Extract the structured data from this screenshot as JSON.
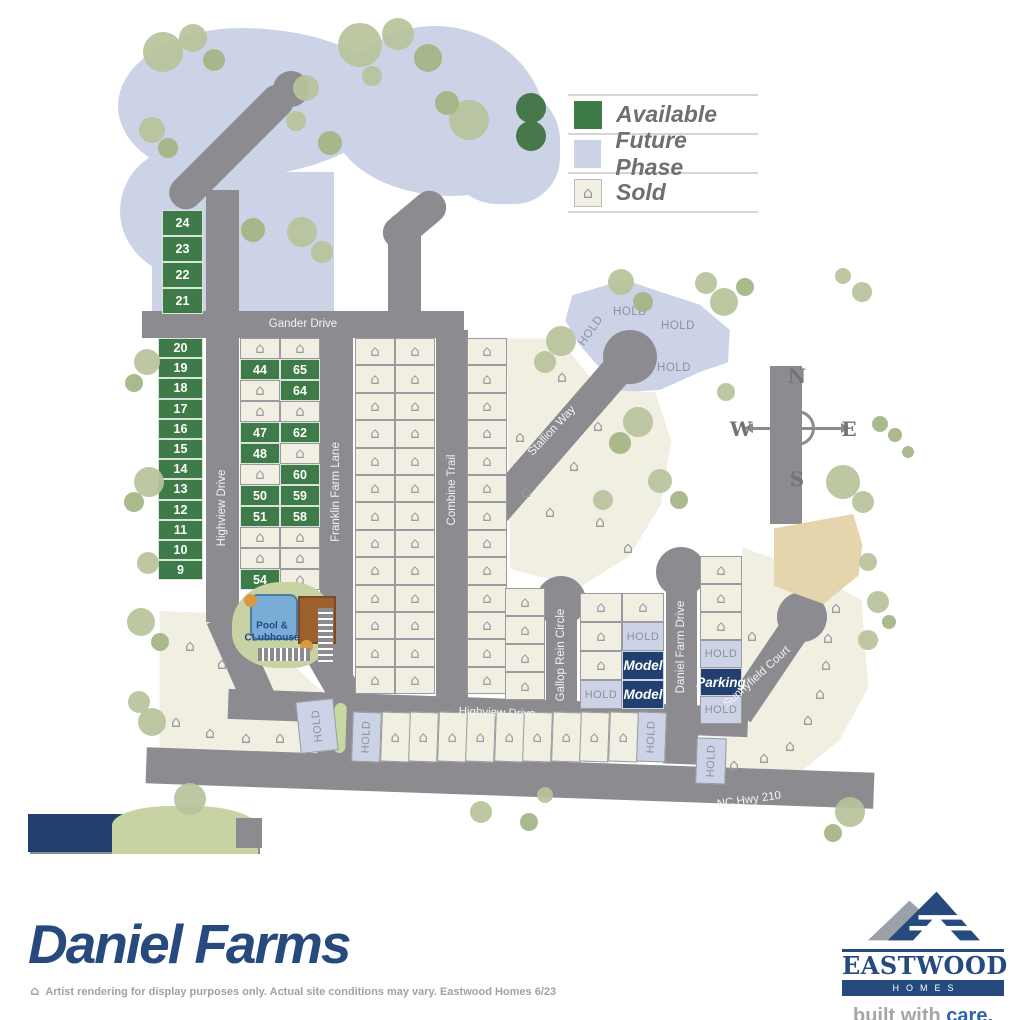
{
  "colors": {
    "road": "#8b8b90",
    "available": "#3e7b48",
    "sold_fill": "#f1eee2",
    "sold_border": "#9a9aa0",
    "future": "#ccd3e7",
    "hold_text": "#8f909a",
    "navy": "#21406f",
    "brand": "#26497e",
    "tan": "#e5d5ad",
    "tree_light": "#b7c29a",
    "tree_mid": "#a3b483",
    "tree_dark": "#47784b",
    "pool_green": "#c8d3a3",
    "pool_blue": "#79add8",
    "clubhouse": "#9c5f2e",
    "median": "#c9d8a0",
    "care_blue": "#2f63ae",
    "legend_text": "#6f6f6f"
  },
  "icons": {
    "house": "⌂"
  },
  "labels": {
    "hold": "HOLD",
    "model": "Model",
    "parking": "Parking"
  },
  "legend": {
    "items": [
      {
        "label": "Available",
        "type": "available"
      },
      {
        "label": "Future Phase",
        "type": "future"
      },
      {
        "label": "Sold",
        "type": "sold"
      }
    ]
  },
  "compass": {
    "n": "N",
    "w": "W",
    "e": "E",
    "s": "S"
  },
  "pool": {
    "line1": "Pool &",
    "line2": "CLubhouse"
  },
  "brand": {
    "title": "Daniel Farms"
  },
  "footer": {
    "disclaimer": "Artist rendering for display purposes only. Actual site conditions may vary. Eastwood Homes 6/23"
  },
  "logo": {
    "name": "EASTWOOD",
    "sub": "HOMES",
    "tag1": "built with ",
    "tag2": "care."
  },
  "map": {
    "future": [
      {
        "x": 118,
        "y": 28,
        "w": 272,
        "h": 150,
        "br": "45% 55% 62% 38% / 52% 46% 54% 48%"
      },
      {
        "x": 120,
        "y": 148,
        "w": 148,
        "h": 132,
        "br": "42% 58% 46% 54% / 48% 42% 58% 52%"
      },
      {
        "x": 152,
        "y": 172,
        "w": 182,
        "h": 142,
        "br": "0"
      },
      {
        "x": 332,
        "y": 26,
        "w": 214,
        "h": 170,
        "br": "48% 52% 44% 56% / 55% 60% 40% 45%"
      },
      {
        "x": 446,
        "y": 88,
        "w": 114,
        "h": 116,
        "br": "40% 45% 40% 45%"
      }
    ],
    "polys": [
      {
        "x": 560,
        "y": 276,
        "w": 175,
        "h": 120,
        "bg": "future",
        "clip": "polygon(7% 16%,37% 3%,57% 13%,80% 24%,97% 45%,96% 72%,80% 80%,57% 95%,35% 97%,11% 57%,3% 37%)"
      },
      {
        "x": 505,
        "y": 336,
        "w": 175,
        "h": 256,
        "bg": "sold_fill",
        "clip": "polygon(1% 1%,31% 1%,54% 21%,86% 22%,95% 41%,89% 66%,71% 86%,43% 98%,3% 91%)"
      },
      {
        "x": 700,
        "y": 545,
        "w": 170,
        "h": 238,
        "bg": "sold_fill",
        "clip": "polygon(25% 1%,60% 10%,95% 23%,99% 60%,82% 82%,53% 99%,6% 93%,1% 72%,24% 64%)"
      },
      {
        "x": 156,
        "y": 608,
        "w": 180,
        "h": 150,
        "bg": "sold_fill",
        "clip": "polygon(2% 2%,45% 4%,98% 62%,99% 98%,2% 98%)"
      }
    ],
    "roads": [
      {
        "x": 206,
        "y": 190,
        "w": 33,
        "h": 432
      },
      {
        "x": 215,
        "y": 66,
        "w": 33,
        "h": 162,
        "rot": 45,
        "rx": 16
      },
      {
        "x": 142,
        "y": 311,
        "w": 322,
        "h": 27
      },
      {
        "x": 320,
        "y": 330,
        "w": 33,
        "h": 345
      },
      {
        "x": 324,
        "y": 645,
        "w": 33,
        "h": 82,
        "rot": -30
      },
      {
        "x": 388,
        "y": 212,
        "w": 33,
        "h": 122,
        "rx": 16
      },
      {
        "x": 398,
        "y": 184,
        "w": 33,
        "h": 72,
        "rot": 50,
        "rx": 16
      },
      {
        "x": 436,
        "y": 330,
        "w": 32,
        "h": 378
      },
      {
        "x": 524,
        "y": 335,
        "w": 32,
        "h": 248,
        "rot": 41
      },
      {
        "x": 770,
        "y": 366,
        "w": 32,
        "h": 158
      },
      {
        "x": 546,
        "y": 598,
        "w": 31,
        "h": 112
      },
      {
        "x": 666,
        "y": 566,
        "w": 31,
        "h": 148
      },
      {
        "x": 753,
        "y": 613,
        "w": 31,
        "h": 110,
        "rot": 34
      },
      {
        "x": 228,
        "y": 698,
        "w": 520,
        "h": 30,
        "rot": 2
      },
      {
        "x": 146,
        "y": 760,
        "w": 728,
        "h": 36,
        "rot": 2
      },
      {
        "x": 318,
        "y": 696,
        "w": 46,
        "h": 64,
        "rot": 2
      },
      {
        "x": 664,
        "y": 712,
        "w": 34,
        "h": 52,
        "rot": 2
      },
      {
        "x": 224,
        "y": 613,
        "w": 34,
        "h": 92,
        "rot": -24
      },
      {
        "x": 30,
        "y": 820,
        "w": 230,
        "h": 34
      }
    ],
    "culdesacs": [
      [
        630,
        357,
        27
      ],
      [
        561,
        601,
        25
      ],
      [
        681,
        572,
        25
      ],
      [
        802,
        617,
        25
      ],
      [
        291,
        89,
        18
      ]
    ],
    "shapes": [
      {
        "nm": "open-space",
        "x": 774,
        "y": 514,
        "w": 92,
        "h": 90,
        "bg": "tan",
        "clip": "polygon(0% 16%,86% 0%,96% 34%,92% 68%,54% 100%,0% 80%)"
      },
      {
        "nm": "pond",
        "x": 28,
        "y": 814,
        "w": 130,
        "h": 38,
        "bg": "navy",
        "clip": "polygon(0 0,100% 0,70% 100%,0 100%)"
      },
      {
        "nm": "green-patch",
        "x": 112,
        "y": 806,
        "w": 146,
        "h": 48,
        "bg": "pool_green",
        "br": "40% 45% 0 0"
      },
      {
        "nm": "road-stub",
        "x": 236,
        "y": 818,
        "w": 26,
        "h": 30,
        "bg": "road"
      },
      {
        "nm": "median",
        "x": 334,
        "y": 703,
        "w": 12,
        "h": 50,
        "bg": "median",
        "br": "6px",
        "rot": 2
      }
    ],
    "grids": [
      {
        "x": 162,
        "y": 210,
        "cw": 41,
        "ch": 26,
        "cols": 1,
        "cells": [
          "a:24",
          "a:23",
          "a:22",
          "a:21"
        ]
      },
      {
        "x": 158,
        "y": 338,
        "cw": 45,
        "ch": 20.2,
        "cols": 1,
        "cells": [
          "a:20",
          "a:19",
          "a:18",
          "a:17",
          "a:16",
          "a:15",
          "a:14",
          "a:13",
          "a:12",
          "a:11",
          "a:10",
          "a:9"
        ]
      },
      {
        "x": 240,
        "y": 338,
        "cw": 40,
        "ch": 21,
        "cols": 2,
        "cells": [
          "s",
          "s",
          "a:44",
          "a:65",
          "s",
          "a:64",
          "s",
          "s",
          "a:47",
          "a:62",
          "a:48",
          "s",
          "s",
          "a:60",
          "a:50",
          "a:59",
          "a:51",
          "a:58",
          "s",
          "s",
          "s",
          "s",
          "a:54",
          "s"
        ]
      },
      {
        "x": 355,
        "y": 338,
        "cw": 40,
        "ch": 27.4,
        "cols": 2,
        "cells": [
          "s",
          "s",
          "s",
          "s",
          "s",
          "s",
          "s",
          "s",
          "s",
          "s",
          "s",
          "s",
          "s",
          "s",
          "s",
          "s",
          "s",
          "s",
          "s",
          "s",
          "s",
          "s",
          "s",
          "s",
          "s",
          "s"
        ]
      },
      {
        "x": 467,
        "y": 338,
        "cw": 40,
        "ch": 27.4,
        "cols": 1,
        "cells": [
          "s",
          "s",
          "s",
          "s",
          "s",
          "s",
          "s",
          "s",
          "s",
          "s",
          "s",
          "s",
          "s"
        ]
      },
      {
        "x": 505,
        "y": 588,
        "cw": 40,
        "ch": 28,
        "cols": 1,
        "cells": [
          "s",
          "s",
          "s",
          "s"
        ]
      },
      {
        "x": 580,
        "y": 593,
        "cw": 42,
        "ch": 29,
        "cols": 1,
        "cells": [
          "s",
          "s",
          "s",
          "h"
        ]
      },
      {
        "x": 622,
        "y": 593,
        "cw": 42,
        "ch": 29,
        "cols": 1,
        "cells": [
          "s",
          "h",
          "m",
          "m"
        ]
      },
      {
        "x": 700,
        "y": 556,
        "cw": 42,
        "ch": 28,
        "cols": 1,
        "cells": [
          "s",
          "s",
          "s",
          "h",
          "p",
          "h"
        ]
      },
      {
        "x": 352,
        "y": 712,
        "cw": 28.5,
        "ch": 50,
        "cols": 11,
        "rot": 2,
        "cells": [
          "hv",
          "s",
          "s",
          "s",
          "s",
          "s",
          "s",
          "s",
          "s",
          "s",
          "hv"
        ]
      }
    ],
    "lots": [
      {
        "x": 298,
        "y": 700,
        "w": 38,
        "h": 52,
        "rot": -6,
        "t": "hv"
      },
      {
        "x": 696,
        "y": 738,
        "w": 30,
        "h": 46,
        "rot": 2,
        "t": "hv"
      }
    ],
    "houses": [
      [
        520,
        437
      ],
      [
        526,
        492
      ],
      [
        550,
        512
      ],
      [
        574,
        466
      ],
      [
        598,
        426
      ],
      [
        562,
        377
      ],
      [
        600,
        522
      ],
      [
        628,
        548
      ],
      [
        752,
        636
      ],
      [
        828,
        638
      ],
      [
        826,
        665
      ],
      [
        820,
        694
      ],
      [
        808,
        720
      ],
      [
        790,
        746
      ],
      [
        764,
        758
      ],
      [
        734,
        765
      ],
      [
        836,
        608
      ],
      [
        190,
        646
      ],
      [
        222,
        664
      ],
      [
        176,
        722
      ],
      [
        210,
        733
      ],
      [
        246,
        738
      ],
      [
        280,
        738
      ]
    ],
    "hold_texts": [
      [
        630,
        312,
        0
      ],
      [
        678,
        326,
        0
      ],
      [
        674,
        368,
        0
      ],
      [
        591,
        331,
        -55
      ]
    ],
    "streets": [
      {
        "t": "Gander Drive",
        "x": 303,
        "y": 324,
        "r": 0
      },
      {
        "t": "Highview Drive",
        "x": 222,
        "y": 508,
        "r": -90
      },
      {
        "t": "Franklin Farm Lane",
        "x": 336,
        "y": 492,
        "r": -90
      },
      {
        "t": "Combine Trail",
        "x": 452,
        "y": 490,
        "r": -90
      },
      {
        "t": "Stallion Way",
        "x": 552,
        "y": 431,
        "r": -47
      },
      {
        "t": "Gallop Rein Circle",
        "x": 561,
        "y": 655,
        "r": -90
      },
      {
        "t": "Daniel Farm Drive",
        "x": 681,
        "y": 647,
        "r": -90
      },
      {
        "t": "Sunnyfield Court",
        "x": 757,
        "y": 677,
        "r": -42
      },
      {
        "t": "Highview Drive",
        "x": 497,
        "y": 713,
        "r": 2
      },
      {
        "t": "NC Hwy 210",
        "x": 749,
        "y": 800,
        "r": -8
      }
    ],
    "trees": [
      [
        163,
        52,
        20,
        0
      ],
      [
        193,
        38,
        14,
        0
      ],
      [
        214,
        60,
        11,
        1
      ],
      [
        152,
        130,
        13,
        0
      ],
      [
        168,
        148,
        10,
        1
      ],
      [
        306,
        88,
        13,
        0
      ],
      [
        296,
        121,
        10,
        0
      ],
      [
        330,
        143,
        12,
        1
      ],
      [
        302,
        232,
        15,
        0
      ],
      [
        322,
        252,
        11,
        0
      ],
      [
        253,
        230,
        12,
        1
      ],
      [
        360,
        45,
        22,
        0
      ],
      [
        398,
        34,
        16,
        0
      ],
      [
        428,
        58,
        14,
        1
      ],
      [
        372,
        76,
        10,
        0
      ],
      [
        469,
        120,
        20,
        0
      ],
      [
        447,
        103,
        12,
        1
      ],
      [
        531,
        108,
        15,
        2
      ],
      [
        531,
        136,
        15,
        2
      ],
      [
        621,
        282,
        13,
        0
      ],
      [
        643,
        302,
        10,
        1
      ],
      [
        561,
        341,
        15,
        0
      ],
      [
        545,
        362,
        11,
        0
      ],
      [
        706,
        283,
        11,
        0
      ],
      [
        724,
        302,
        14,
        0
      ],
      [
        745,
        287,
        9,
        1
      ],
      [
        862,
        292,
        10,
        0
      ],
      [
        843,
        276,
        8,
        0
      ],
      [
        638,
        422,
        15,
        0
      ],
      [
        620,
        443,
        11,
        1
      ],
      [
        843,
        482,
        17,
        0
      ],
      [
        863,
        502,
        11,
        0
      ],
      [
        880,
        424,
        8,
        1
      ],
      [
        726,
        392,
        9,
        0
      ],
      [
        147,
        362,
        13,
        0
      ],
      [
        134,
        383,
        9,
        1
      ],
      [
        149,
        482,
        15,
        0
      ],
      [
        134,
        502,
        10,
        1
      ],
      [
        148,
        563,
        11,
        0
      ],
      [
        141,
        622,
        14,
        0
      ],
      [
        160,
        642,
        9,
        1
      ],
      [
        139,
        702,
        11,
        0
      ],
      [
        152,
        722,
        14,
        0
      ],
      [
        190,
        799,
        16,
        0
      ],
      [
        481,
        812,
        11,
        0
      ],
      [
        529,
        822,
        9,
        1
      ],
      [
        850,
        812,
        15,
        0
      ],
      [
        833,
        833,
        9,
        1
      ],
      [
        545,
        795,
        8,
        0
      ],
      [
        878,
        602,
        11,
        0
      ],
      [
        889,
        622,
        7,
        1
      ],
      [
        868,
        562,
        9,
        0
      ],
      [
        660,
        481,
        12,
        0
      ],
      [
        679,
        500,
        9,
        1
      ],
      [
        603,
        500,
        10,
        0
      ],
      [
        868,
        640,
        10,
        0
      ],
      [
        895,
        435,
        7,
        1
      ],
      [
        908,
        452,
        6,
        1
      ]
    ]
  }
}
